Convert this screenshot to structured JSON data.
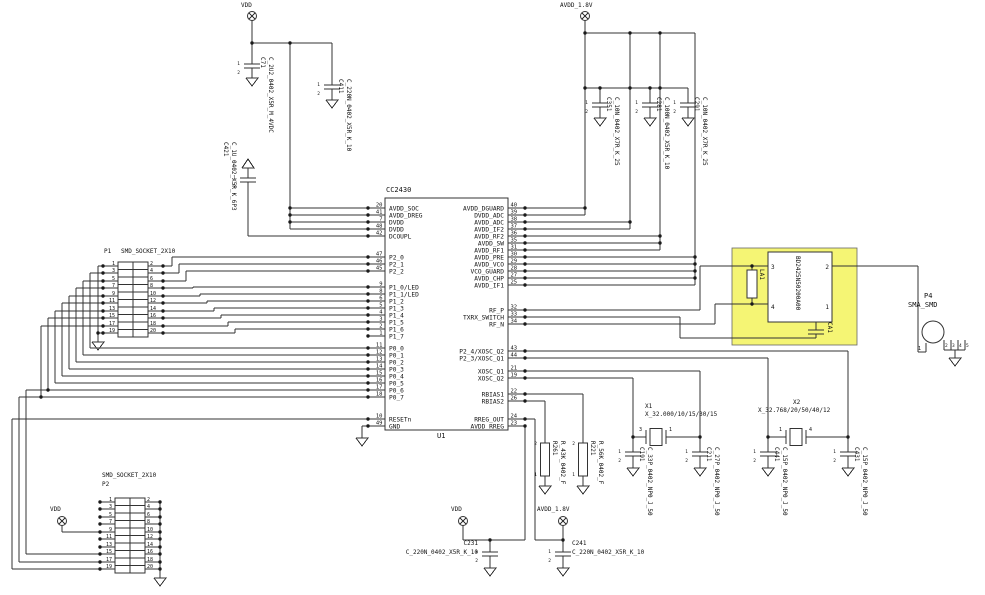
{
  "schematic": {
    "colors": {
      "highlight_fill": "#f5f574",
      "wire": "#333333"
    },
    "ic": {
      "part": "CC2430",
      "designator": "U1",
      "left_groups": [
        [
          {
            "num": "20",
            "name": "AVDD_SOC"
          },
          {
            "num": "41",
            "name": "AVDD_DREG"
          },
          {
            "num": "7",
            "name": "DVDD"
          },
          {
            "num": "48",
            "name": "DVDD"
          },
          {
            "num": "42",
            "name": "DCOUPL"
          }
        ],
        [
          {
            "num": "47",
            "name": "P2_0"
          },
          {
            "num": "46",
            "name": "P2_1"
          },
          {
            "num": "45",
            "name": "P2_2"
          }
        ],
        [
          {
            "num": "9",
            "name": "P1_0/LED"
          },
          {
            "num": "8",
            "name": "P1_1/LED"
          },
          {
            "num": "6",
            "name": "P1_2"
          },
          {
            "num": "5",
            "name": "P1_3"
          },
          {
            "num": "4",
            "name": "P1_4"
          },
          {
            "num": "3",
            "name": "P1_5"
          },
          {
            "num": "2",
            "name": "P1_6"
          },
          {
            "num": "1",
            "name": "P1_7"
          }
        ],
        [
          {
            "num": "11",
            "name": "P0_0"
          },
          {
            "num": "12",
            "name": "P0_1"
          },
          {
            "num": "13",
            "name": "P0_2"
          },
          {
            "num": "14",
            "name": "P0_3"
          },
          {
            "num": "15",
            "name": "P0_4"
          },
          {
            "num": "16",
            "name": "P0_5"
          },
          {
            "num": "17",
            "name": "P0_6"
          },
          {
            "num": "18",
            "name": "P0_7"
          }
        ],
        [
          {
            "num": "10",
            "name": "RESETn"
          },
          {
            "num": "49",
            "name": "GND"
          }
        ]
      ],
      "right_groups": [
        [
          {
            "num": "40",
            "name": "AVDD_DGUARD"
          },
          {
            "num": "39",
            "name": "DVDD_ADC"
          },
          {
            "num": "38",
            "name": "AVDD_ADC"
          },
          {
            "num": "37",
            "name": "AVDD_IF2"
          },
          {
            "num": "36",
            "name": "AVDD_RF2"
          },
          {
            "num": "35",
            "name": "AVDD_SW"
          },
          {
            "num": "31",
            "name": "AVDD_RF1"
          },
          {
            "num": "30",
            "name": "AVDD_PRE"
          },
          {
            "num": "29",
            "name": "AVDD_VCO"
          },
          {
            "num": "28",
            "name": "VCO_GUARD"
          },
          {
            "num": "27",
            "name": "AVDD_CHP"
          },
          {
            "num": "25",
            "name": "AVDD_IF1"
          }
        ],
        [
          {
            "num": "32",
            "name": "RF_P"
          },
          {
            "num": "33",
            "name": "TXRX_SWITCH"
          },
          {
            "num": "34",
            "name": "RF_N"
          }
        ],
        [
          {
            "num": "43",
            "name": "P2_4/XOSC_Q2"
          },
          {
            "num": "44",
            "name": "P2_3/XOSC_Q1"
          }
        ],
        [
          {
            "num": "21",
            "name": "XOSC_Q1"
          },
          {
            "num": "19",
            "name": "XOSC_Q2"
          }
        ],
        [
          {
            "num": "22",
            "name": "RBIAS1"
          },
          {
            "num": "26",
            "name": "RBIAS2"
          }
        ],
        [
          {
            "num": "24",
            "name": "RREG_OUT"
          },
          {
            "num": "23",
            "name": "AVDD_RREG"
          }
        ]
      ]
    },
    "nets": {
      "vdd": "VDD",
      "avdd18": "AVDD_1.8V"
    },
    "connectors": {
      "p1": {
        "designator": "P1",
        "part": "SMD_SOCKET_2X10",
        "left_pins": [
          "1",
          "3",
          "5",
          "7",
          "9",
          "11",
          "13",
          "15",
          "17",
          "19"
        ],
        "right_pins": [
          "2",
          "4",
          "6",
          "8",
          "10",
          "12",
          "14",
          "16",
          "18",
          "20"
        ]
      },
      "p2": {
        "designator": "P2",
        "part": "SMD_SOCKET_2X10",
        "left_pins": [
          "1",
          "3",
          "5",
          "7",
          "9",
          "11",
          "13",
          "15",
          "17",
          "19"
        ],
        "right_pins": [
          "2",
          "4",
          "6",
          "8",
          "10",
          "12",
          "14",
          "16",
          "18",
          "20"
        ]
      },
      "p4": {
        "designator": "P4",
        "part": "SMA_SMD",
        "pin1": "1",
        "gnd_pins": [
          "2",
          "3",
          "4",
          "5"
        ]
      }
    },
    "capacitors": [
      {
        "des": "C71",
        "value": "C_2U2_0402_X5R_M_4VDC"
      },
      {
        "des": "C421",
        "value": "C_1U_0402_X5R_K_6P3"
      },
      {
        "des": "C411",
        "value": "C_220N_0402_X5R_K_10"
      },
      {
        "des": "C351",
        "value": "C_10N_0402_X7R_K_25"
      },
      {
        "des": "C281",
        "value": "C_100N_0402_X5R_K_10"
      },
      {
        "des": "C291",
        "value": "C_10N_0402_X7R_K_25"
      },
      {
        "des": "C191",
        "value": "C_33P_0402_NP0_J_50"
      },
      {
        "des": "C211",
        "value": "C_27P_0402_NP0_J_50"
      },
      {
        "des": "C441",
        "value": "C_15P_0402_NP0_J_50"
      },
      {
        "des": "C431",
        "value": "C_15P_0402_NP0_J_50"
      },
      {
        "des": "C231",
        "value": "C_220N_0402_X5R_K_10"
      },
      {
        "des": "C241",
        "value": "C_220N_0402_X5R_K_10"
      }
    ],
    "resistors": [
      {
        "des": "R221",
        "value": "R_56K_0402_F"
      },
      {
        "des": "R261",
        "value": "R_43K_0402_F"
      }
    ],
    "crystals": [
      {
        "des": "X1",
        "value": "X_32.000/10/15/30/15",
        "pin_left": "3",
        "pin_right": "1"
      },
      {
        "des": "X2",
        "value": "X_32.768/20/50/40/12",
        "pin_left": "1",
        "pin_right": "4"
      }
    ],
    "balun": {
      "part": "BD2425N50200A00",
      "pin_tl": "3",
      "pin_tr": "2",
      "pin_bl": "4",
      "pin_br": "1",
      "inductor_des": "LA1",
      "cap_des": "CA1"
    },
    "pin_pair": {
      "p1": "1",
      "p2": "2"
    }
  }
}
